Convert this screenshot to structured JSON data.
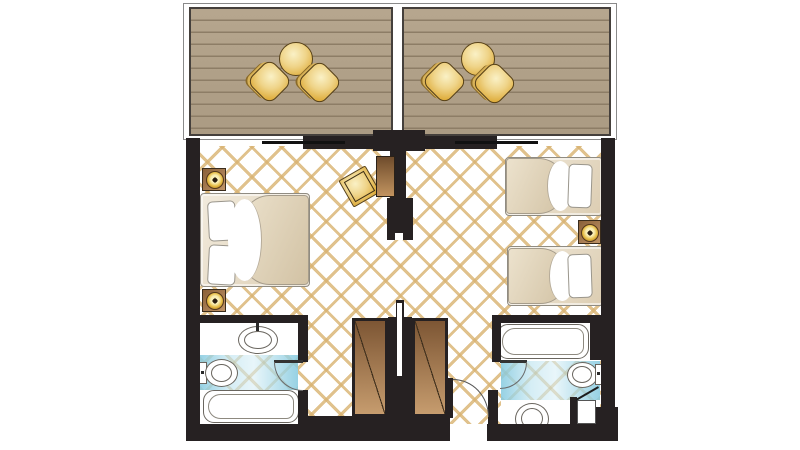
{
  "scene": {
    "kind": "hotel-family-room-floor-plan",
    "balconies": [
      {
        "id": "left-balcony",
        "furniture": [
          "round-table",
          "chair",
          "chair"
        ],
        "deck": "wood-plank"
      },
      {
        "id": "right-balcony",
        "furniture": [
          "round-table",
          "chair",
          "chair"
        ],
        "deck": "wood-plank"
      }
    ],
    "rooms": [
      {
        "id": "left-bedroom",
        "furniture": [
          "double-bed",
          "nightstand-with-lamp",
          "nightstand-with-lamp",
          "tv-cabinet",
          "gold-ottoman"
        ],
        "window": "sliding-glass-door"
      },
      {
        "id": "right-bedroom",
        "furniture": [
          "single-bed",
          "single-bed",
          "nightstand-with-lamp"
        ],
        "window": "sliding-glass-door"
      }
    ],
    "bathrooms": [
      {
        "id": "left-bathroom",
        "fixtures": [
          "oval-washbasin",
          "toilet",
          "bathtub"
        ],
        "floor_strip": "blue-tile",
        "door": "swing-in"
      },
      {
        "id": "right-bathroom",
        "fixtures": [
          "bathtub",
          "toilet",
          "round-washbasin",
          "shower-stall"
        ],
        "floor_strip": "blue-tile",
        "door": "swing-in"
      }
    ],
    "core": {
      "party_wall": "double-wall-with-cavity",
      "wardrobes": [
        "left-wardrobe",
        "right-wardrobe"
      ],
      "entry_door": "bottom-right-swing-in"
    }
  },
  "palette": {
    "wall": "#262122",
    "deck": "#b6a68e",
    "deck-line": "#8d7d66",
    "lattice": "#d8b270",
    "gold": "#dfae3e",
    "wood-dark": "#6f4c2c",
    "wood-light": "#c1935f",
    "blue": "#7dc6dd",
    "fixture-line": "#6a665f"
  }
}
